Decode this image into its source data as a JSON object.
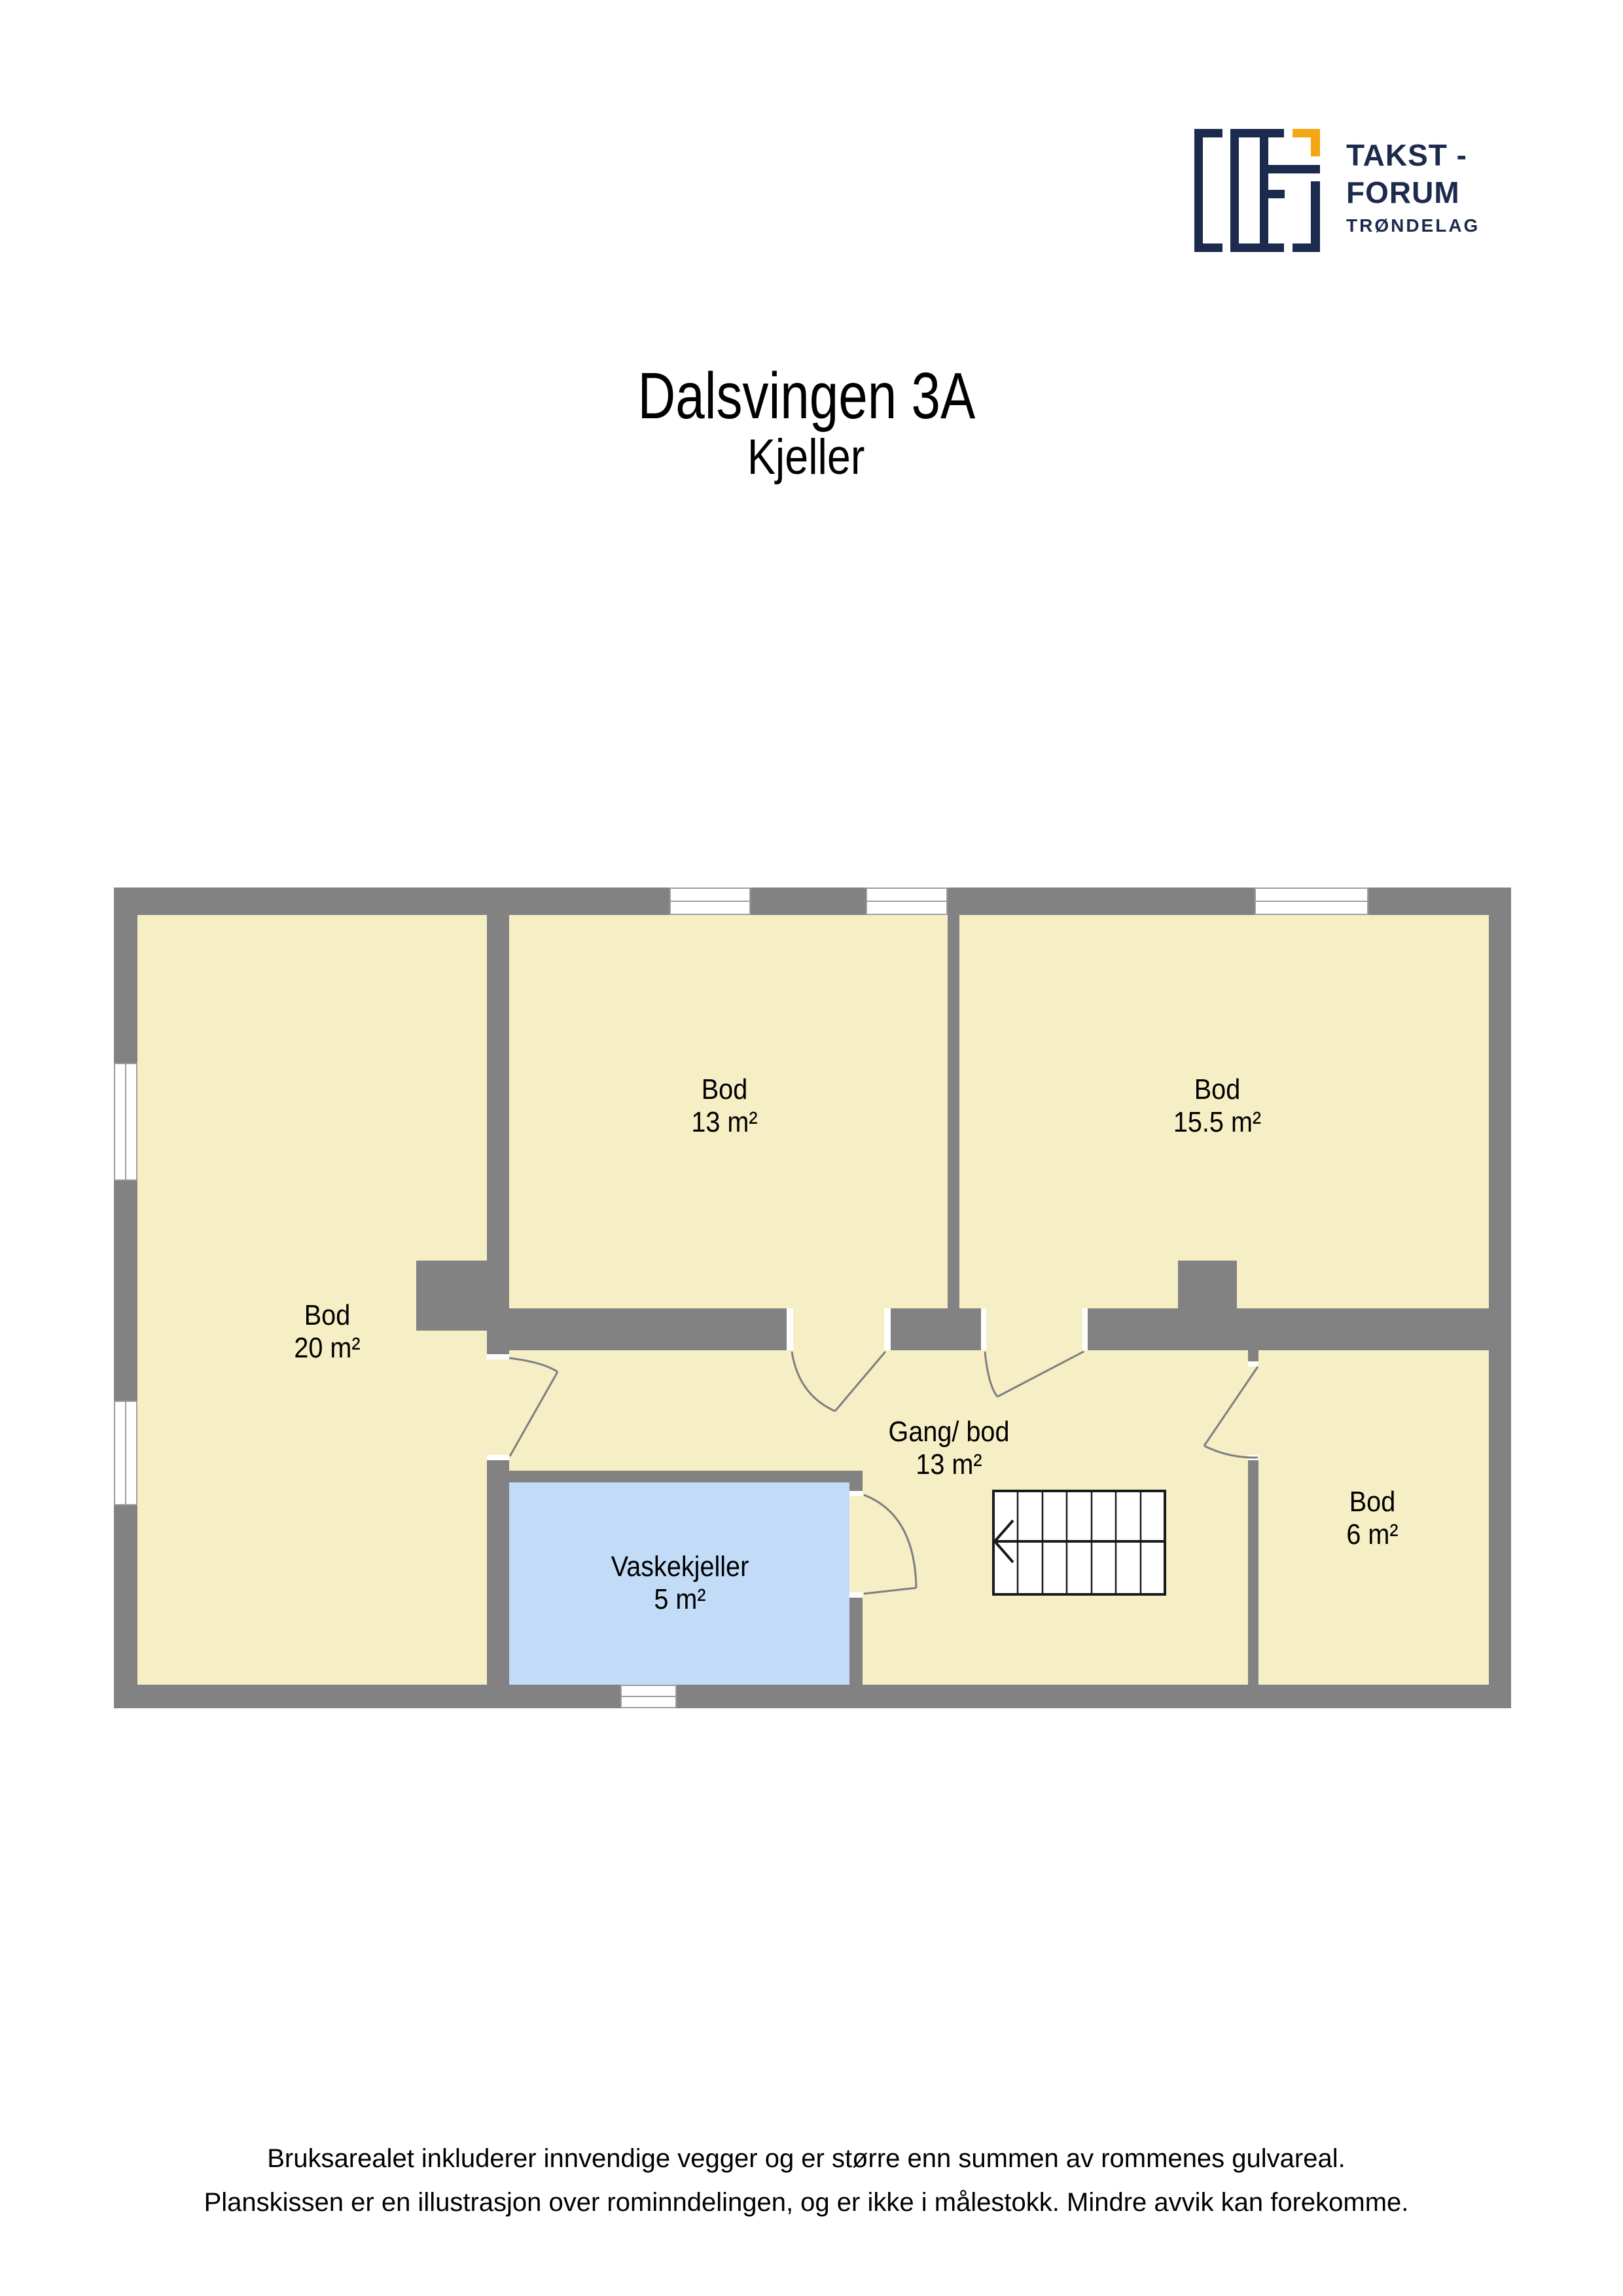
{
  "header": {
    "title": "Dalsvingen 3A",
    "subtitle": "Kjeller"
  },
  "logo": {
    "line1": "TAKST -",
    "line2": "FORUM",
    "line3": "TRØNDELAG"
  },
  "rooms": [
    {
      "name": "Bod",
      "area": "20 m²"
    },
    {
      "name": "Bod",
      "area": "13 m²"
    },
    {
      "name": "Bod",
      "area": "15.5 m²"
    },
    {
      "name": "Gang/ bod",
      "area": "13 m²"
    },
    {
      "name": "Vaskekjeller",
      "area": "5 m²"
    },
    {
      "name": "Bod",
      "area": "6 m²"
    }
  ],
  "stairs": {
    "treads": 7,
    "direction_arrow": "left"
  },
  "footer": {
    "line1": "Bruksarealet inkluderer innvendige vegger og er større enn summen av rommenes gulvareal.",
    "line2": "Planskissen er en illustrasjon over rominndelingen, og er ikke i målestokk. Mindre avvik kan forekomme."
  },
  "colors": {
    "wall": "#828282",
    "floor": "#F6EFC5",
    "laundry_floor": "#C2DCF8",
    "brand_navy": "#1B2A4D",
    "brand_orange": "#F3A712",
    "door_line": "#7F7F7F"
  }
}
